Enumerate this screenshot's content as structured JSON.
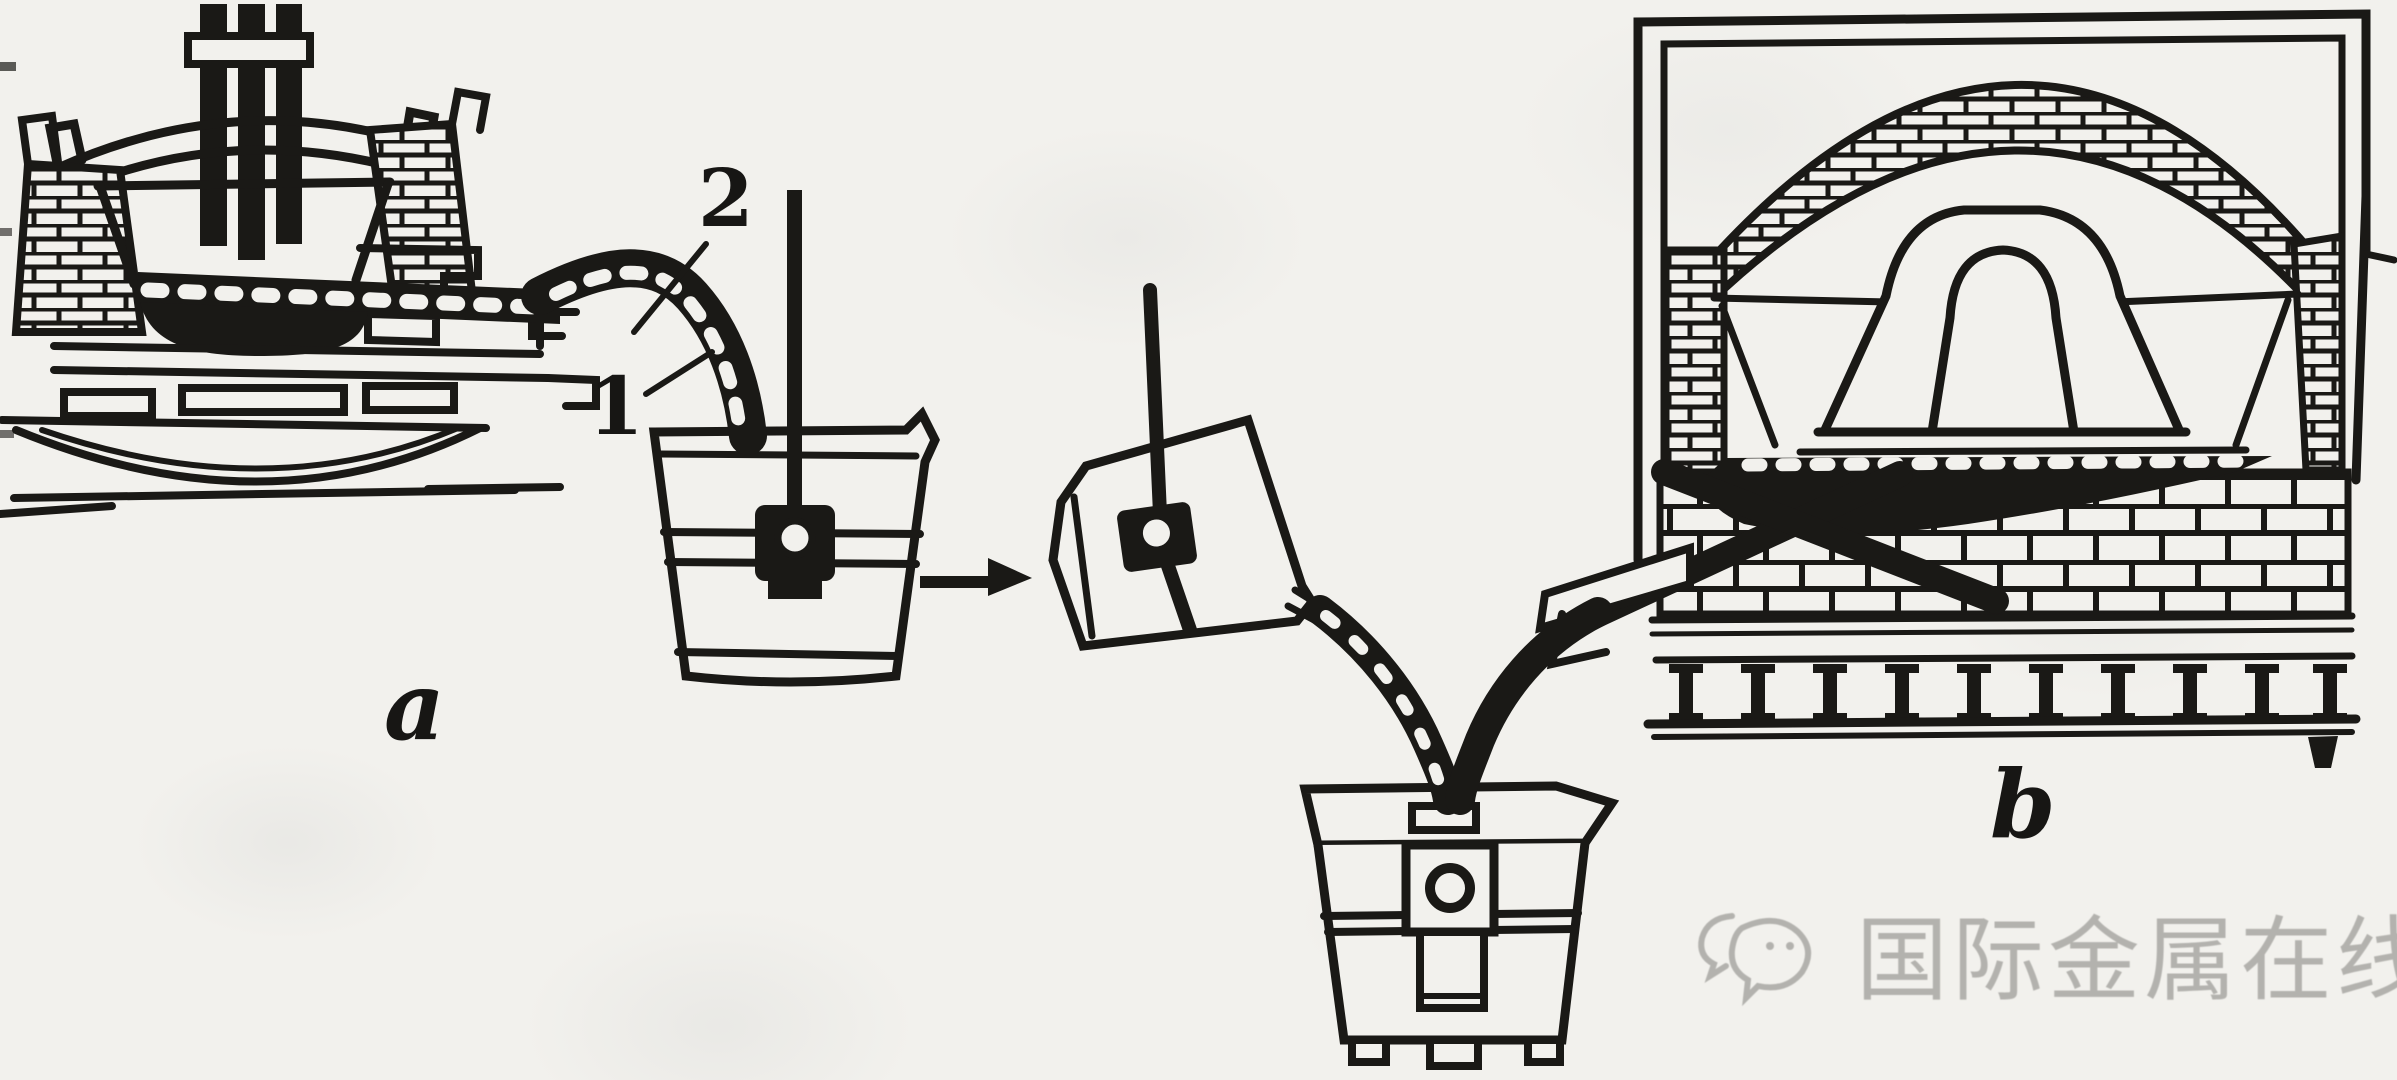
{
  "figure": {
    "type": "technical-diagram",
    "caption_labels": {
      "stream": "2",
      "launder": "1",
      "panel_a": "a",
      "panel_b": "b"
    },
    "watermark": {
      "icon": "chat-bubbles-icon",
      "text": "国际金属在线"
    },
    "colors": {
      "ink": "#1a1916",
      "paper": "#f2f1ed",
      "watermark": "#a9a8a4"
    },
    "parts": [
      "electric-arc-furnace",
      "tapping-launder",
      "tapping-stream",
      "transfer-ladle",
      "transfer-arrow",
      "tilted-pouring-ladle",
      "holding-furnace",
      "furnace-tap-stream",
      "receiving-ladle"
    ]
  }
}
